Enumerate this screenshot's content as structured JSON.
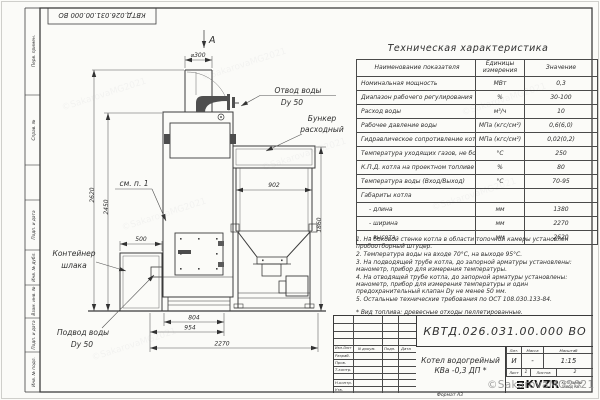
{
  "frame": {
    "left_strip": [
      "Перв. примен.",
      "Справ. №",
      "Подп. и дата",
      "Инв. № дубл.",
      "Взам. инв. №",
      "Подп. и дата",
      "Инв. № подл."
    ],
    "top_stamp": "КВТД.026.031.00.000 ВО",
    "format_label": "Формат А3"
  },
  "drawing": {
    "view_label": "A",
    "labels": {
      "water_outlet_1": "Отвод воды",
      "water_outlet_2": "Dу 50",
      "hopper_1": "Бункер",
      "hopper_2": "расходный",
      "see_note": "см. п. 1",
      "slag_1": "Контейнер",
      "slag_2": "шлака",
      "water_inlet_1": "Подвод воды",
      "water_inlet_2": "Dу 50"
    },
    "dims": {
      "chimney_dia": "⌀300",
      "h2620": "2620",
      "h2450": "2450",
      "w500": "500",
      "w902": "902",
      "h1860": "1860",
      "w804": "804",
      "w954": "954",
      "w2270": "2270"
    }
  },
  "tech_table": {
    "title": "Техническая характеристика",
    "headers": [
      "Наименование показателя",
      "Единицы измерения",
      "Значение"
    ],
    "rows": [
      [
        "Номинальная мощность",
        "МВт",
        "0,3"
      ],
      [
        "Диапазон рабочего регулирования",
        "%",
        "30-100"
      ],
      [
        "Расход воды",
        "м³/ч",
        "10"
      ],
      [
        "Рабочее давление воды",
        "МПа (кгс/см²)",
        "0,6(6,0)"
      ],
      [
        "Гидравлическое сопротивление котла",
        "МПа (кгс/см²)",
        "0,02(0,2)"
      ],
      [
        "Температура уходящих газов, не более",
        "°С",
        "250"
      ],
      [
        "К.П.Д. котла на проектном топливе",
        "%",
        "80"
      ],
      [
        "Температура воды (Вход/Выход)",
        "°С",
        "70-95"
      ],
      [
        "Габариты котла",
        "",
        ""
      ],
      [
        "- длина",
        "мм",
        "1380"
      ],
      [
        "- ширина",
        "мм",
        "2270"
      ],
      [
        "- высота",
        "мм",
        "2620"
      ]
    ]
  },
  "notes": {
    "lines": [
      "1. На боковой стенке котла в области топочной камеры установлен пробоотборный штуцер.",
      "2. Температура воды на входе 70°С, на выходе 95°С.",
      "3. На подводящей трубе котла, до запорной арматуры установлены: манометр, прибор для измерения температуры.",
      "4. На отводящей трубе котла, до запорной арматуры установлены: манометр, прибор для измерения температуры и один предохранительный клапан Dу не менее 50 мм.",
      "5. Остальные технические требования по ОСТ 108.030.133-84.",
      "* Вид топлива: древесные отходы пеллетированные."
    ]
  },
  "title_block": {
    "designation": "КВТД.026.031.00.000 ВО",
    "header_cols": [
      "Изм.Лист",
      "N докум.",
      "Подп.",
      "Дата"
    ],
    "row_labels": [
      "Разраб.",
      "Пров.",
      "Т.контр.",
      "Н.контр.",
      "Утв."
    ],
    "name_line1": "Котел водогрейный",
    "name_line2": "КВа -0,3 ДП *",
    "lit_header": "Лит.",
    "mass_header": "Масса",
    "scale_header": "Масштаб",
    "lit_value": "И",
    "mass_value": "-",
    "scale_value": "1:15",
    "sheet_label": "Лист",
    "sheet_value": "1",
    "sheets_label": "Листов",
    "sheets_value": "2",
    "logo_text": "KVZR",
    "company_line1": "КОТЕЛЬНЫЙ",
    "company_line2": "ЗАВОД РЭП"
  },
  "watermark": "©SakarovaMG2021"
}
